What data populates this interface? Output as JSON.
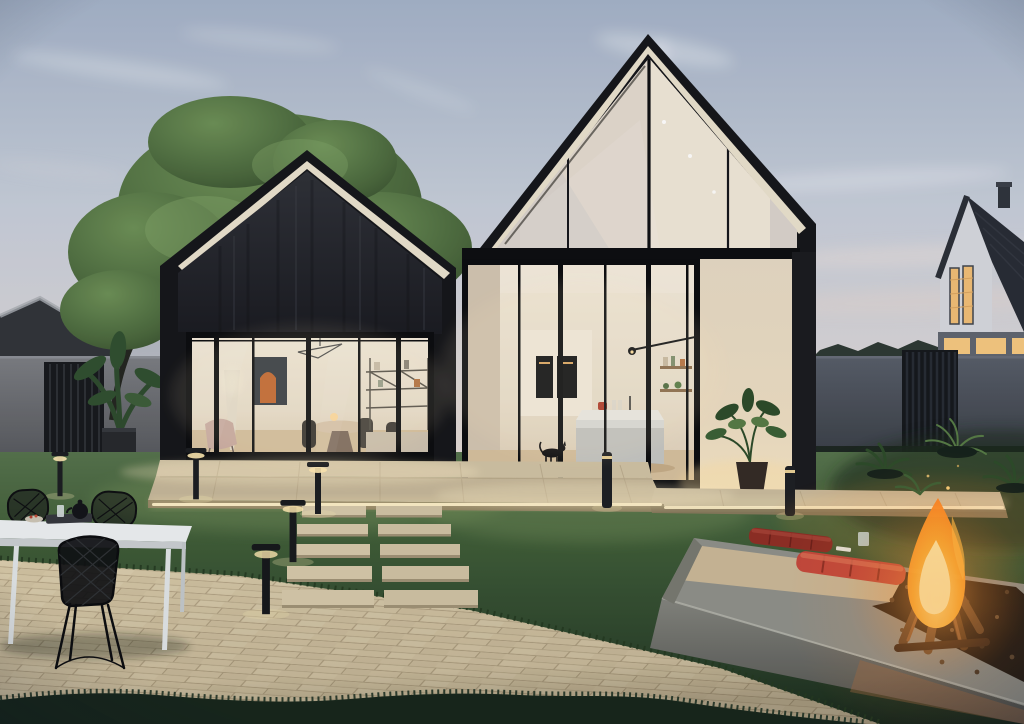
{
  "scene": {
    "type": "photo",
    "description": "Dusk exterior rendering of two modern black gabled cabin volumes with fully glazed fronts: left cabin shows a warmly lit living-dining room, taller right cabin shows a lit kitchen with island, wall ovens and a black cat. Backyard with lawn, beige paver terrace, stone garden steps, bollard path lights, white outdoor table with black wire chairs, concrete fire pit with burning log fire and two red quilted cushions, large green tree, banana plant in a cube planter, grey boundary walls with slatted gates, ferns, and a white neighbouring house with lit windows under a pale evening sky with wispy clouds.",
    "objects": [
      "evening-sky",
      "cloud-streaks",
      "garden-tree",
      "banana-plant",
      "barn-silhouette",
      "left-boundary-wall",
      "left-slat-fence",
      "right-boundary-wall",
      "right-slat-gate",
      "treeline",
      "background-house",
      "left-cabin",
      "right-cabin",
      "living-room-interior",
      "kitchen-interior",
      "black-cat",
      "potted-plant",
      "patio-platform",
      "led-light-strip",
      "garden-steps",
      "bollard-lights",
      "paver-terrace",
      "outdoor-table",
      "wire-chairs",
      "teapot",
      "fire-pit",
      "fire-flame",
      "logs",
      "red-cushions",
      "ferns",
      "lawn"
    ]
  },
  "colors": {
    "sky_top": "#a3b1c6",
    "sky_mid": "#c9cfd9",
    "sky_horizon": "#e0d7d2",
    "cloud_white": "#ffffff",
    "hill_haze": "#9aa3b0",
    "treeline_dark": "#2c3831",
    "bg_house_wall": "#d5d7dc",
    "bg_house_roof": "#272b33",
    "window_warm": "#f2c27c",
    "wall_left": "#76787c",
    "wall_right": "#4e545c",
    "fence_dark": "#16181c",
    "tree_light": "#6c8f55",
    "tree_dark": "#3a5230",
    "trunk_dark": "#23251f",
    "grass_light": "#5d7c49",
    "grass_mid": "#3f5c36",
    "grass_dark": "#1f3120",
    "grass_fringe": "#16251a",
    "roof_black": "#141518",
    "soffit_cream": "#e9e0cb",
    "interior_wall": "#ece1cf",
    "interior_floor": "#d5bf9c",
    "frame_black": "#0b0c0e",
    "cream_wall": "#ecdfc8",
    "column_dark": "#1a1b1e",
    "platform": "#cfc1a2",
    "platform_front": "#8f8160",
    "led_warm": "#fff1c8",
    "paver_light": "#d7c8a6",
    "paver_joint": "#b3a383",
    "step_stone": "#d5c7a8",
    "bollard_dark": "#1b1d20",
    "table_white": "#eceff0",
    "chair_black": "#0d0e10",
    "concrete_top": "#8e8f88",
    "concrete_front": "#6f706b",
    "deck_tan": "#c9b795",
    "mulch_dark": "#211a13",
    "cushion_front": "#c4473a",
    "cushion_back": "#8e2d23",
    "log_brown": "#5d4128",
    "flame_outer": "#ff7d1f",
    "flame_mid": "#ffb640",
    "flame_inner": "#ffe9a8",
    "plant_dark": "#2c4a28",
    "plant_light": "#567a44",
    "pot_dark": "#332a24"
  }
}
